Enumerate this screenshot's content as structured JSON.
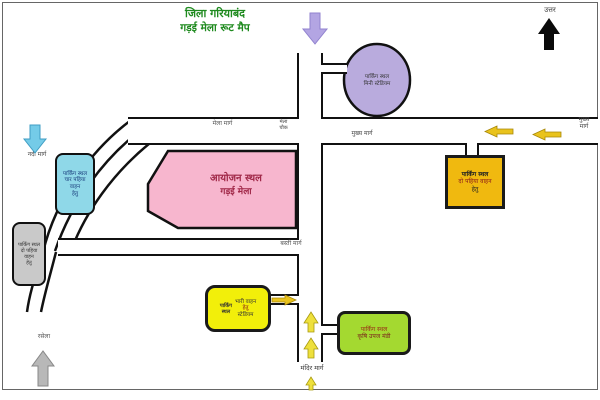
{
  "title": {
    "line1": "जिला गरियाबंद",
    "line2": "गड़ई मेला रूट मैप"
  },
  "compass": {
    "label": "उत्तर"
  },
  "venue": {
    "line1": "आयोजन स्थल",
    "line2": "गड़ई मेला"
  },
  "parking_stadium": {
    "line1": "पार्किंग स्थल",
    "line2": "मिनी स्टेडियम"
  },
  "parking_two_wheeler_right": {
    "line1": "पार्किंग स्थल",
    "line2": "दो पहिया वाहन",
    "line3": "हेतु"
  },
  "parking_four_wheeler": {
    "line1": "पार्किंग स्थल",
    "line2": "चार पहिया",
    "line3": "वाहन",
    "line4": "हेतु"
  },
  "parking_two_wheeler_left": {
    "line1": "पार्किंग स्थल",
    "line2": "दो पहिया",
    "line3": "वाहन",
    "line4": "हेतु"
  },
  "parking_heavy": {
    "side1": "पार्किंग",
    "side2": "स्थल",
    "line1": "भारी वाहन",
    "line2": "हेतु",
    "line3": "स्टेडियम"
  },
  "parking_mandi": {
    "line1": "पार्किंग स्थल",
    "line2": "कृषि उपज मंडी"
  },
  "road_labels": {
    "left_road": "मेला मार्ग",
    "junction_line1": "मेला",
    "junction_line2": "चौक",
    "mid_road": "मुख्य मार्ग",
    "right_edge_line1": "मुख्य",
    "right_edge_line2": "मार्ग",
    "lower_road": "बस्ती मार्ग",
    "temple_road": "मंदिर मार्ग",
    "river_side": "नदी मार्ग",
    "rasela": "रसेला"
  },
  "colors": {
    "title_green": "#1e8a1e",
    "venue_pink": "#f7b6ce",
    "stadium_lavender": "#b9abdd",
    "right_parking_yellow": "#f0b90f",
    "heavy_parking_yellow": "#f2ef0a",
    "mandi_green": "#a4d930",
    "four_wheeler_cyan": "#8fd8e8",
    "two_wheeler_gray": "#c9c9c9",
    "arrow_yellow": "#e9c31d",
    "arrow_cyan": "#74cbe8",
    "arrow_lavender": "#b3a5e3",
    "arrow_gray": "#b8b8b8",
    "arrow_black": "#0a0a0a"
  }
}
